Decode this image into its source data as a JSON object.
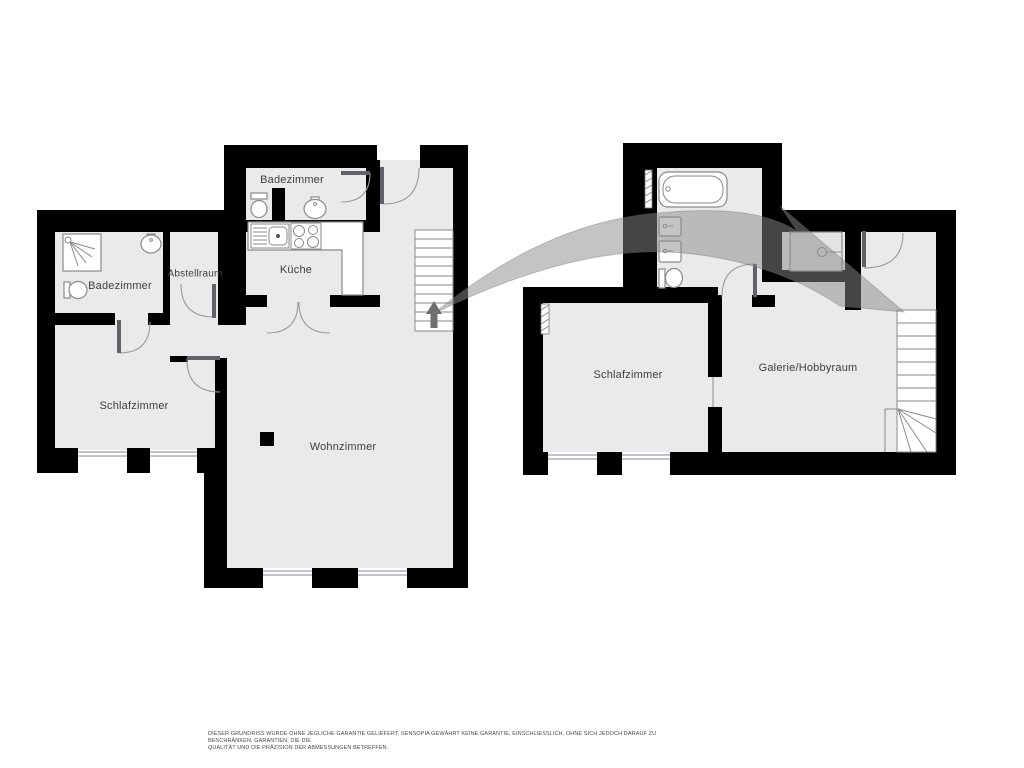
{
  "plans": {
    "ground_floor": {
      "rooms": [
        {
          "id": "badezimmer-top",
          "label": "Badezimmer"
        },
        {
          "id": "badezimmer-left",
          "label": "Badezimmer"
        },
        {
          "id": "abstellraum",
          "label": "Abstellraum"
        },
        {
          "id": "kueche",
          "label": "Küche"
        },
        {
          "id": "schlafzimmer",
          "label": "Schlafzimmer"
        },
        {
          "id": "wohnzimmer",
          "label": "Wohnzimmer"
        }
      ]
    },
    "upper_floor": {
      "rooms": [
        {
          "id": "schlafzimmer",
          "label": "Schlafzimmer"
        },
        {
          "id": "galerie",
          "label": "Galerie/Hobbyraum"
        }
      ]
    }
  },
  "disclaimer": {
    "line1": "DIESER GRUNDRISS WURDE OHNE JEGLICHE GARANTIE GELIEFERT. SENSOPIA GEWÄHRT KEINE GARANTIE, EINSCHLIESSLICH, OHNE SICH JEDOCH DARAUF ZU BESCHRÄNKEN, GARANTIEN, DIE DIE",
    "line2": "QUALITÄT UND DIE PRÄZISION DER ABMESSUNGEN BETREFFEN."
  },
  "colors": {
    "wall": "#000000",
    "floor": "#e9eaec",
    "line": "#8a8a8a",
    "door": "#9a9a9a",
    "leaf": "#5f6368",
    "label": "#3c4043",
    "arrow": "#8a8a8a",
    "arrowGlyph": "#6f6f6f"
  }
}
